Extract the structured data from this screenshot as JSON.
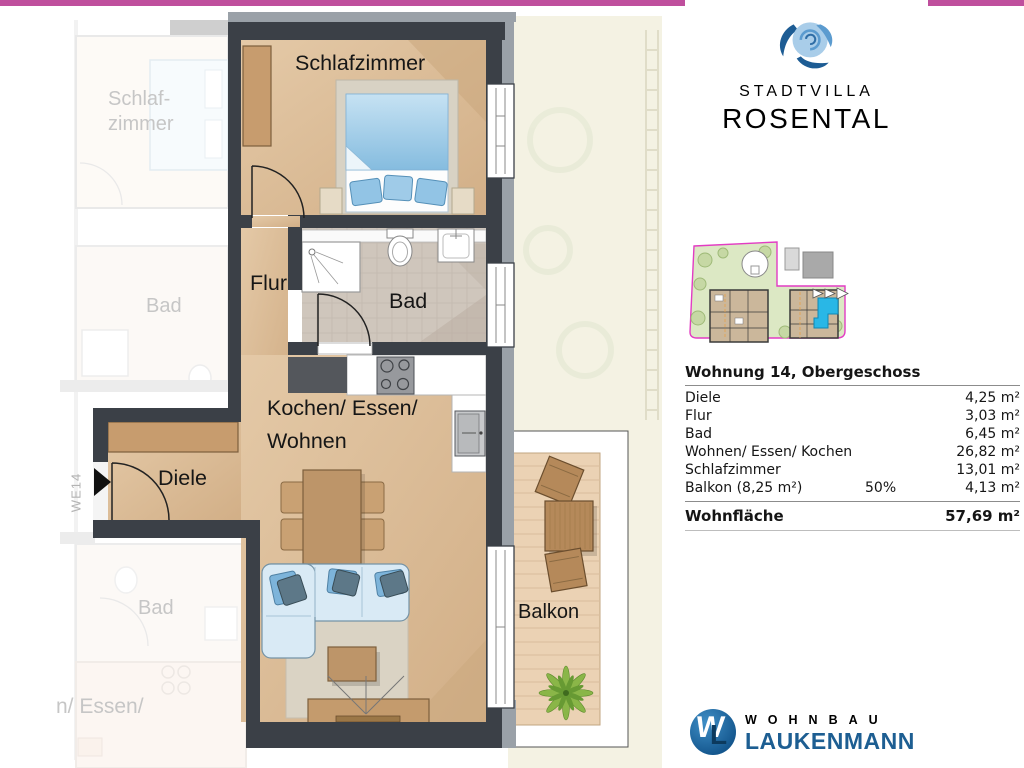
{
  "theme": {
    "magenta": "#bf4f9d",
    "card_pink": "#d48fc0",
    "bar_blue": "#1b9ad0",
    "brand_light": "#3f9fd9",
    "brand_dark": "#2a6187",
    "footer_bar": "#2679ae",
    "wall_dark": "#3b4047",
    "wall_gray": "#9aa1a8",
    "accent_cyan": "#29b7e6"
  },
  "branding": {
    "line1": "STADTVILLA",
    "line2": "ROSENTAL"
  },
  "header": {
    "title": "Wohnung Nr.14| OG | Objekt Nr.630"
  },
  "floor_plan": {
    "labels": {
      "schlafzimmer": "Schlafzimmer",
      "flur": "Flur",
      "bad": "Bad",
      "kochen_essen": "Kochen/ Essen/",
      "wohnen": "Wohnen",
      "diele": "Diele",
      "balkon": "Balkon",
      "unit_tag": "WE14"
    },
    "neighbor_labels": {
      "schlaf_line1": "Schlaf-",
      "schlaf_line2": "zimmer",
      "bad_top": "Bad",
      "bad_bottom": "Bad",
      "essen_partial": "n/ Essen/"
    }
  },
  "area_table": {
    "title": "Wohnung 14, Obergeschoss",
    "rows": [
      {
        "name": "Diele",
        "note": "",
        "value": "4,25 m²"
      },
      {
        "name": "Flur",
        "note": "",
        "value": "3,03 m²"
      },
      {
        "name": "Bad",
        "note": "",
        "value": "6,45 m²"
      },
      {
        "name": "Wohnen/ Essen/ Kochen",
        "note": "",
        "value": "26,82 m²"
      },
      {
        "name": "Schlafzimmer",
        "note": "",
        "value": "13,01 m²"
      },
      {
        "name": "Balkon (8,25 m²)",
        "note": "50%",
        "value": "4,13 m²"
      }
    ],
    "total": {
      "name": "Wohnfläche",
      "value": "57,69 m²"
    }
  },
  "footer": {
    "company_line1": "WOHNBAU",
    "company_line2": "LAUKENMANN",
    "monogram_w": "W",
    "monogram_l": "L"
  }
}
